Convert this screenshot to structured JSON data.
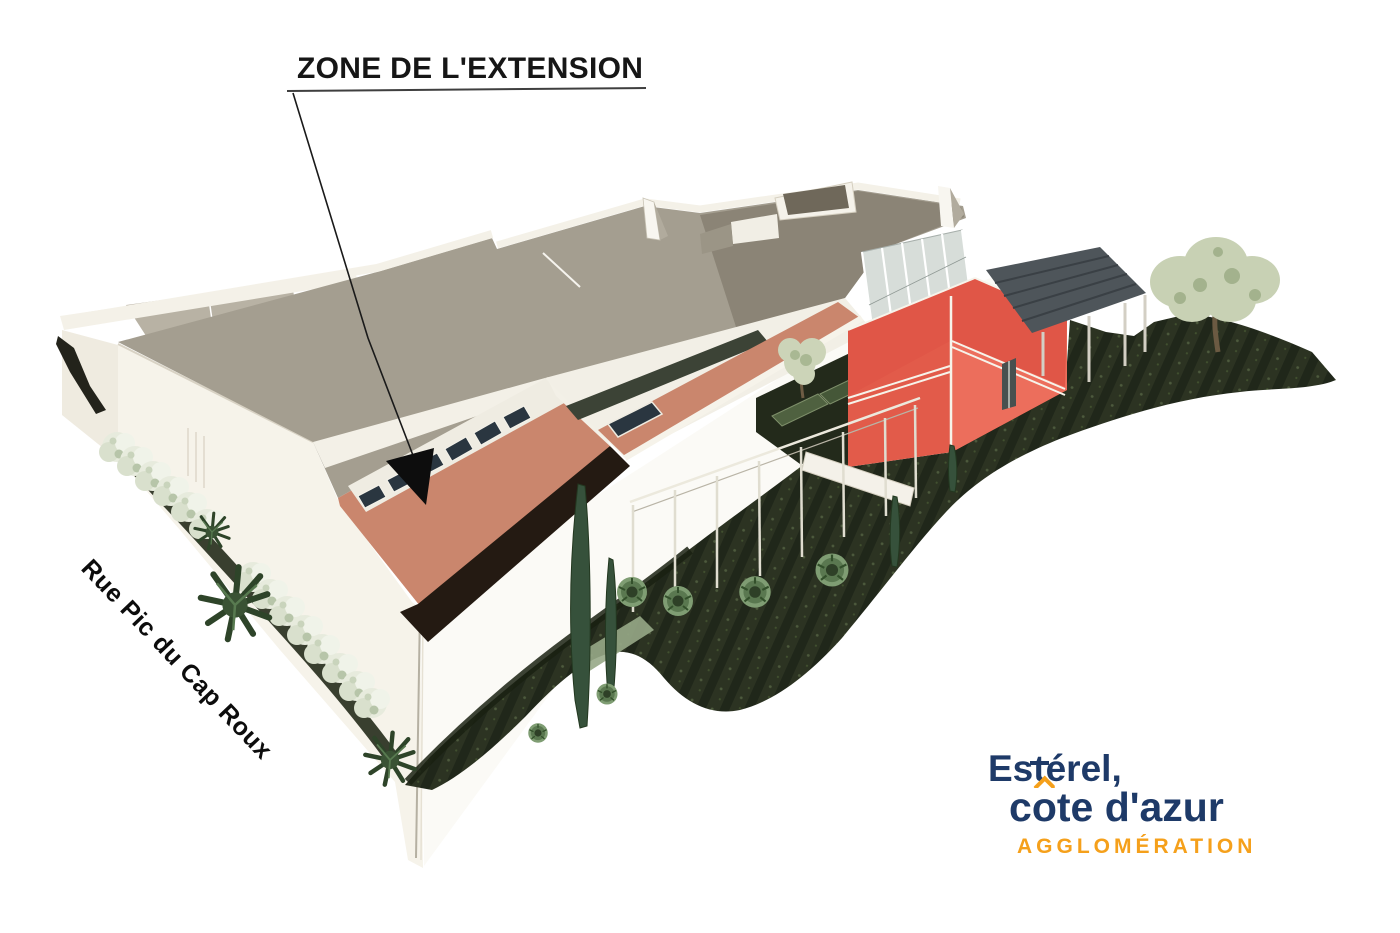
{
  "annotation": {
    "title": "ZONE DE L'EXTENSION",
    "arrow_target": "salmon extension roof of the main hall"
  },
  "street_label": "Rue Pic du Cap Roux",
  "logo": {
    "line1": "Estérel",
    "line1_parts": {
      "pre": "Es",
      "t": "t",
      "post": "érel",
      "tail": ","
    },
    "line2": "côte d'azur",
    "line2_parts": {
      "pre": "c",
      "o": "o",
      "post": "te d'azur"
    },
    "line3": "AGGLOMÉRATION",
    "navy": "#1e3a68",
    "orange": "#f5a01b"
  },
  "scene": {
    "description": "Aerial 3D rendering of a sports hall with planned extension zone, annex building, canopies and landscaped grounds",
    "colors": {
      "page_bg": "#ffffff",
      "title_text": "#161616",
      "street_text": "#0c0c0c",
      "underline": "#3f3f3f",
      "arrow": "#0d0d0d",
      "main_roof": "#a49e90",
      "roof_left_panels": "#b8b2a4",
      "roof_right_section": "#8b8476",
      "extension_roof": "#ca866d",
      "skylight_glass": "#2a3640",
      "shadow_band": "#241a12",
      "parapet_white": "#f3f0e7",
      "wall_sw": "#f6f3ea",
      "wall_se": "#fbfaf6",
      "red_building": "#e25b4a",
      "red_building_light": "#ec6e5c",
      "canopy": "#4e555a",
      "glass": "#d7ddd9",
      "ground": "#2c3322",
      "hedge": "#1a2112",
      "bush_green": "#5a7850",
      "pale_shrub": "#e7ebdd",
      "cypress_green": "#36513b",
      "olive_foliage": "#c8d1b4"
    }
  }
}
